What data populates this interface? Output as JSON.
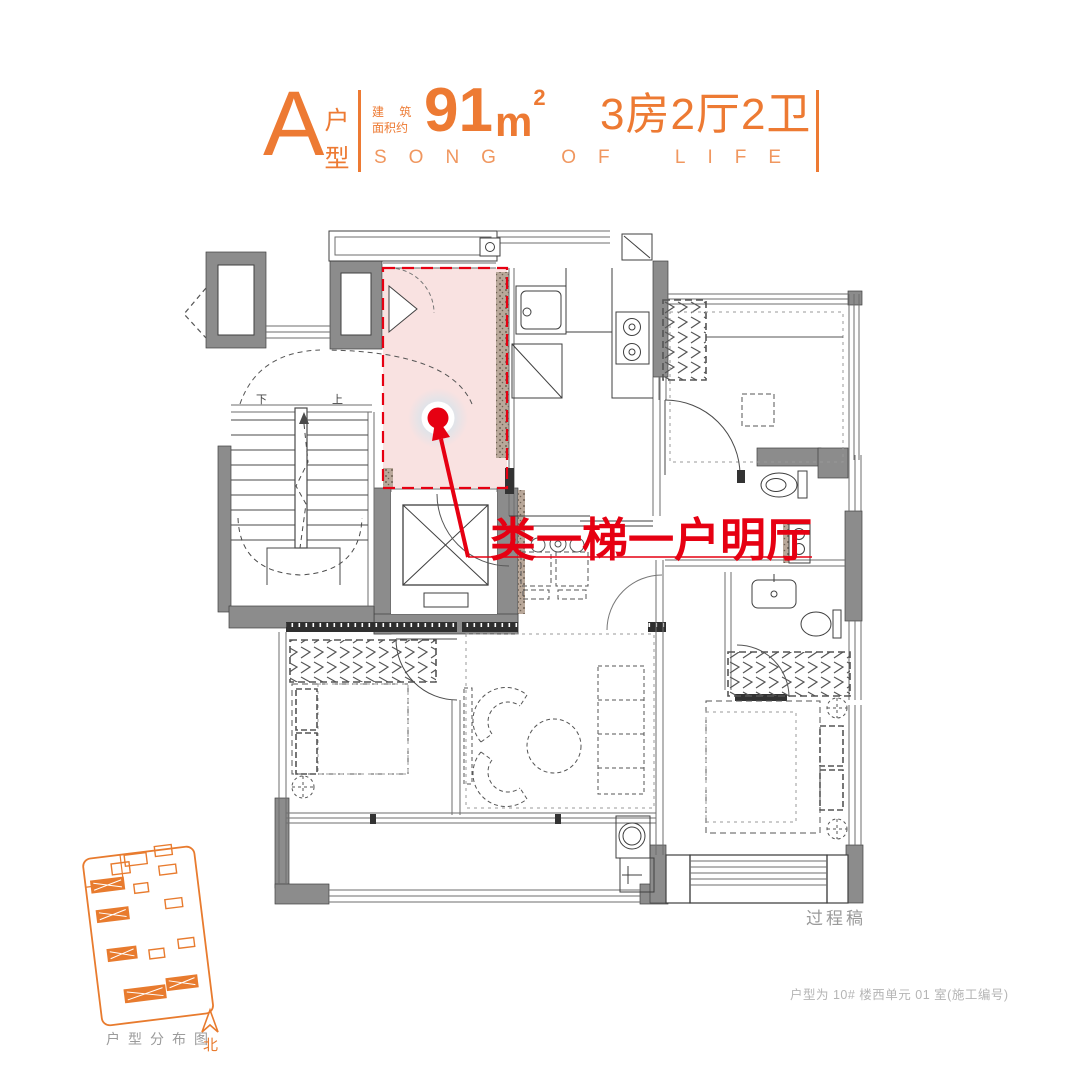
{
  "colors": {
    "accent_orange": "#ED7A33",
    "subtitle_orange": "#F0975F",
    "sitemap_orange": "#E87B2E",
    "annotation_red": "#E60012",
    "highlight_pink": "#F9E2E1",
    "wall_gray": "#8C8C8C",
    "line_dark": "#3F3F3F",
    "watermark_gray": "#9A9A9A",
    "footnote_gray": "#B5B5B5"
  },
  "header": {
    "unit_letter": "A",
    "unit_type_top": "户",
    "unit_type_bottom": "型",
    "area_label_line1": "建 筑",
    "area_label_line2": "面积约",
    "area_value": "91",
    "area_unit": "m",
    "area_exponent": "2",
    "rooms": "3房2厅2卫",
    "subtitle": "SONG OF LIFE"
  },
  "plan": {
    "annotation": "类一梯一户明厅",
    "stairs_down": "下",
    "stairs_up": "上",
    "watermark": "过程稿"
  },
  "footer": {
    "note": "户型为 10# 楼西单元 01 室(施工编号)"
  },
  "sitemap": {
    "caption": "户型分布图",
    "north": "北"
  }
}
